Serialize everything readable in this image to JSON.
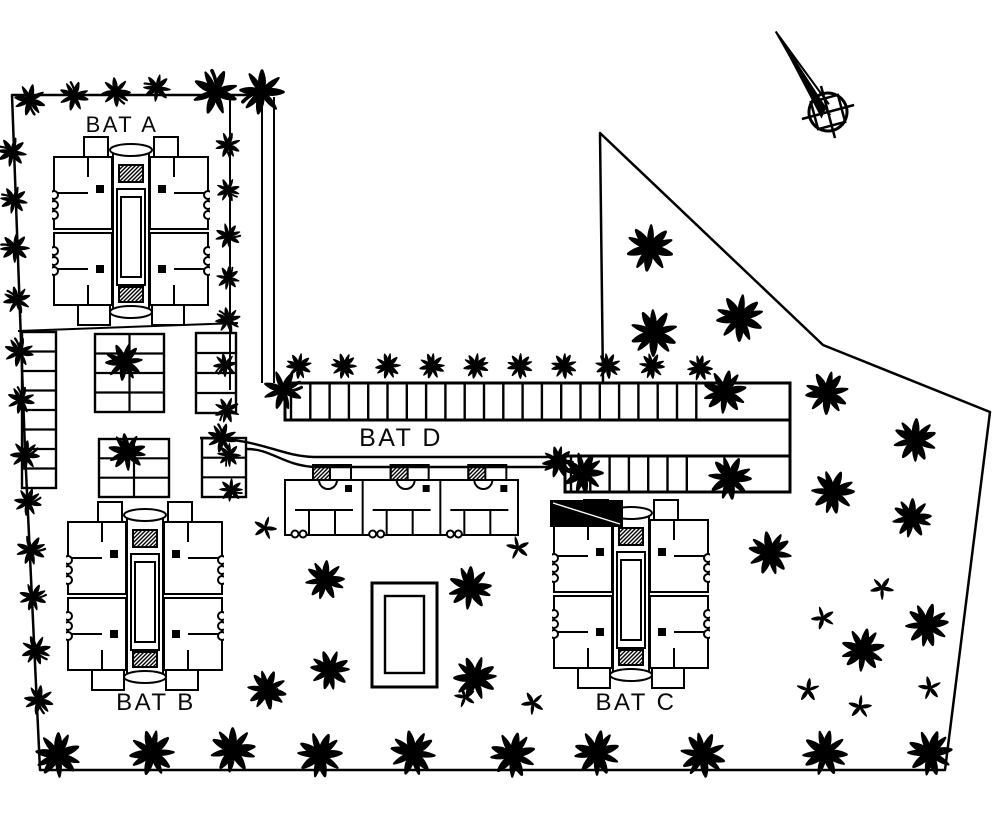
{
  "colors": {
    "ink": "#000000",
    "paper": "#ffffff"
  },
  "labels": {
    "building_a": "BAT A",
    "building_b": "BAT B",
    "building_c": "BAT C",
    "building_d": "BAT D"
  },
  "boundary": {
    "outline": [
      [
        268,
        95
      ],
      [
        12,
        95
      ],
      [
        25,
        450
      ],
      [
        40,
        770
      ],
      [
        945,
        770
      ],
      [
        990,
        412
      ],
      [
        823,
        345
      ],
      [
        600,
        133
      ],
      [
        603,
        383
      ]
    ],
    "lines": [
      [
        [
          262,
          97
        ],
        [
          262,
          383
        ]
      ],
      [
        [
          274,
          97
        ],
        [
          274,
          383
        ]
      ],
      [
        [
          230,
          95
        ],
        [
          230,
          390
        ]
      ],
      [
        [
          18,
          331
        ],
        [
          238,
          323
        ]
      ]
    ]
  },
  "road": {
    "upper": "M200,438 C262,438 278,456 314,457 L566,457",
    "lower": "M247,449 C272,449 284,466 316,467 L566,467"
  },
  "parking": {
    "strips": [
      {
        "x": 285,
        "y": 383,
        "w": 505,
        "h": 37,
        "hatch_from": 291,
        "hatch_to": 706,
        "step": 19.3
      },
      {
        "x": 565,
        "y": 456,
        "w": 225,
        "h": 36,
        "hatch_from": 571,
        "hatch_to": 706,
        "step": 19.3
      }
    ],
    "connector": [
      [
        790,
        420
      ],
      [
        790,
        456
      ]
    ],
    "lots": [
      {
        "x": 22,
        "y": 332,
        "w": 34,
        "h": 156,
        "rows": 8,
        "cols": 1
      },
      {
        "x": 95,
        "y": 334,
        "w": 69,
        "h": 78,
        "rows": 4,
        "cols": 2
      },
      {
        "x": 99,
        "y": 439,
        "w": 70,
        "h": 58,
        "rows": 3,
        "cols": 2
      },
      {
        "x": 196,
        "y": 333,
        "w": 40,
        "h": 80,
        "rows": 4,
        "cols": 1
      },
      {
        "x": 202,
        "y": 438,
        "w": 44,
        "h": 59,
        "rows": 3,
        "cols": 1
      }
    ]
  },
  "pool": {
    "outer": [
      372,
      583,
      65,
      104
    ],
    "inner": [
      385,
      596,
      39,
      77
    ]
  },
  "towers": [
    {
      "id": "bat-a",
      "x": 52,
      "y": 133
    },
    {
      "id": "bat-b",
      "x": 66,
      "y": 498
    },
    {
      "id": "bat-c",
      "x": 552,
      "y": 496
    }
  ],
  "rowhouse": {
    "x": 285,
    "y": 465,
    "w": 233,
    "units": 3
  },
  "annex": {
    "x": 550,
    "y": 500,
    "w": 73,
    "h": 27
  },
  "north_arrow": {
    "x": 828,
    "y": 112,
    "rotation": -33
  },
  "label_layout": {
    "a": {
      "x": 122,
      "y": 132,
      "size": 22
    },
    "b": {
      "x": 156,
      "y": 710,
      "size": 24
    },
    "c": {
      "x": 636,
      "y": 710,
      "size": 24
    },
    "d": {
      "x": 401,
      "y": 446,
      "size": 25
    }
  },
  "trees": [
    [
      "B",
      30,
      100,
      16
    ],
    [
      "B",
      74,
      96,
      15
    ],
    [
      "B",
      116,
      92,
      15
    ],
    [
      "B",
      157,
      88,
      14
    ],
    [
      "B",
      215,
      92,
      23
    ],
    [
      "B",
      262,
      92,
      23
    ],
    [
      "B",
      12,
      152,
      15
    ],
    [
      "B",
      14,
      200,
      14
    ],
    [
      "B",
      15,
      248,
      15
    ],
    [
      "B",
      17,
      300,
      14
    ],
    [
      "B",
      19,
      352,
      15
    ],
    [
      "B",
      21,
      400,
      14
    ],
    [
      "B",
      25,
      455,
      15
    ],
    [
      "B",
      28,
      502,
      14
    ],
    [
      "B",
      31,
      550,
      15
    ],
    [
      "B",
      33,
      597,
      14
    ],
    [
      "B",
      36,
      650,
      15
    ],
    [
      "B",
      39,
      700,
      15
    ],
    [
      "B",
      228,
      145,
      13
    ],
    [
      "B",
      228,
      190,
      12
    ],
    [
      "B",
      228,
      236,
      13
    ],
    [
      "B",
      228,
      278,
      12
    ],
    [
      "B",
      228,
      320,
      13
    ],
    [
      "B",
      225,
      365,
      12
    ],
    [
      "B",
      227,
      410,
      13
    ],
    [
      "B",
      229,
      455,
      12
    ],
    [
      "B",
      231,
      490,
      12
    ],
    [
      "B",
      283,
      390,
      20
    ],
    [
      "B",
      222,
      438,
      15
    ],
    [
      "L",
      299,
      366,
      13
    ],
    [
      "L",
      344,
      366,
      13
    ],
    [
      "L",
      388,
      366,
      13
    ],
    [
      "L",
      432,
      366,
      13
    ],
    [
      "L",
      476,
      366,
      13
    ],
    [
      "L",
      520,
      366,
      13
    ],
    [
      "L",
      564,
      366,
      13
    ],
    [
      "L",
      608,
      366,
      13
    ],
    [
      "L",
      652,
      366,
      13
    ],
    [
      "L",
      700,
      368,
      13
    ],
    [
      "L",
      124,
      362,
      19
    ],
    [
      "L",
      127,
      452,
      19
    ],
    [
      "L",
      650,
      248,
      24
    ],
    [
      "L",
      654,
      333,
      24
    ],
    [
      "L",
      740,
      318,
      24
    ],
    [
      "L",
      827,
      393,
      22
    ],
    [
      "L",
      915,
      440,
      22
    ],
    [
      "L",
      833,
      492,
      22
    ],
    [
      "L",
      912,
      518,
      20
    ],
    [
      "L",
      770,
      553,
      22
    ],
    [
      "L",
      927,
      625,
      22
    ],
    [
      "L",
      863,
      650,
      22
    ],
    [
      "L",
      825,
      753,
      23
    ],
    [
      "L",
      930,
      753,
      23
    ],
    [
      "S",
      882,
      588,
      12
    ],
    [
      "S",
      823,
      618,
      12
    ],
    [
      "S",
      808,
      690,
      12
    ],
    [
      "S",
      930,
      688,
      12
    ],
    [
      "S",
      860,
      707,
      12
    ],
    [
      "L",
      325,
      580,
      20
    ],
    [
      "L",
      330,
      670,
      20
    ],
    [
      "L",
      470,
      588,
      22
    ],
    [
      "L",
      475,
      678,
      22
    ],
    [
      "L",
      583,
      473,
      21
    ],
    [
      "L",
      725,
      392,
      22
    ],
    [
      "L",
      730,
      478,
      22
    ],
    [
      "L",
      558,
      462,
      16
    ],
    [
      "L",
      267,
      690,
      20
    ],
    [
      "S",
      265,
      528,
      12
    ],
    [
      "S",
      270,
      697,
      12
    ],
    [
      "S",
      518,
      548,
      12
    ],
    [
      "S",
      533,
      703,
      12
    ],
    [
      "S",
      465,
      697,
      11
    ],
    [
      "L",
      58,
      755,
      23
    ],
    [
      "L",
      152,
      753,
      23
    ],
    [
      "L",
      233,
      750,
      23
    ],
    [
      "L",
      320,
      755,
      23
    ],
    [
      "L",
      413,
      753,
      23
    ],
    [
      "L",
      513,
      755,
      23
    ],
    [
      "L",
      597,
      753,
      23
    ],
    [
      "L",
      703,
      755,
      23
    ]
  ]
}
